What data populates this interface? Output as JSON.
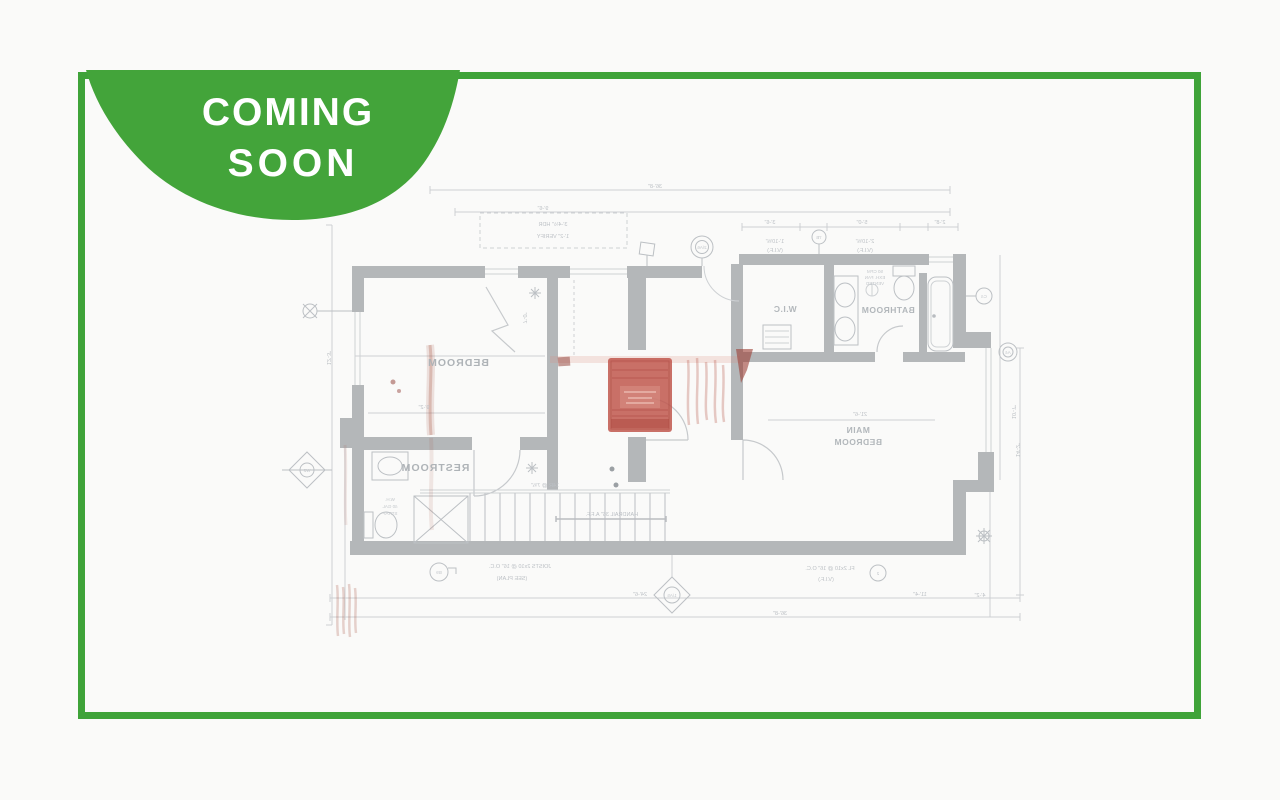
{
  "badge": {
    "line1": "COMING",
    "line2": "SOON"
  },
  "colors": {
    "badge_green": "#43a43a",
    "frame_green": "#3fa339",
    "wall_gray": "#b4b7b9",
    "line_gray": "#c6c9cc",
    "label_gray": "#aeb3b7",
    "stamp_red": "#c0574e"
  },
  "floor_plan": {
    "style": "faded mirrored architectural floor plan watermark",
    "labels": {
      "bedroom": "BEDROOM",
      "restroom": "RESTROOM",
      "wic": "W.I.C",
      "bathroom": "BATHROOM",
      "main_line1": "MAIN",
      "main_line2": "BEDROOM"
    },
    "dims": {
      "top_overall": "36'-8\"",
      "top_inner": "9'-6\"",
      "bath_a": "3'-6\"",
      "bath_b": "5'-0\"",
      "bath_c": "2'-8\"",
      "bath_note1a": "1'-10⅝\"",
      "bath_note1b": "(V.I.F.)",
      "bath_note2a": "2'-10⅝\"",
      "bath_note2b": "(V.I.F.)",
      "hdr_note1": "3'-4½\" HDR",
      "hdr_note2": "1'-2\" VERIFY",
      "bed_width": "9'-2\"",
      "main_width": "21'-6\"",
      "mid_height": "7'-0\"",
      "left_height": "12'-3\"",
      "right_height": "10'-7\"",
      "right_lower": "14'-2\"",
      "bottom_a": "24'-6\"",
      "bottom_b": "11'-4\"",
      "bottom_overall": "36'-8\"",
      "corner": "4'-2\""
    },
    "notes": {
      "fan1": "50 CFM",
      "fan2": "EXH. FAN",
      "fan3": "VENTED",
      "stair": "14R @ 7¾\"",
      "handrail": "HANDRAIL 36\" A.F.F.",
      "wh1": "W.H.",
      "wh2": "40 GAL",
      "wh3": "STRAP",
      "joist1": "JOISTS 2x10 @ 16\" O.C.",
      "joist2": "(SEE PLAN)",
      "rail1": "FL 2x10 @ 16\" O.C.",
      "rail2": "(V.I.F.)"
    },
    "markers": {
      "door_top": "2/A6",
      "bath_top": "7B",
      "right_a": "C4",
      "right_b": "A4",
      "bottom_left": "B9",
      "bottom_mid": "1/A5",
      "left_diamond": "W2",
      "bottom_right": "2"
    }
  }
}
